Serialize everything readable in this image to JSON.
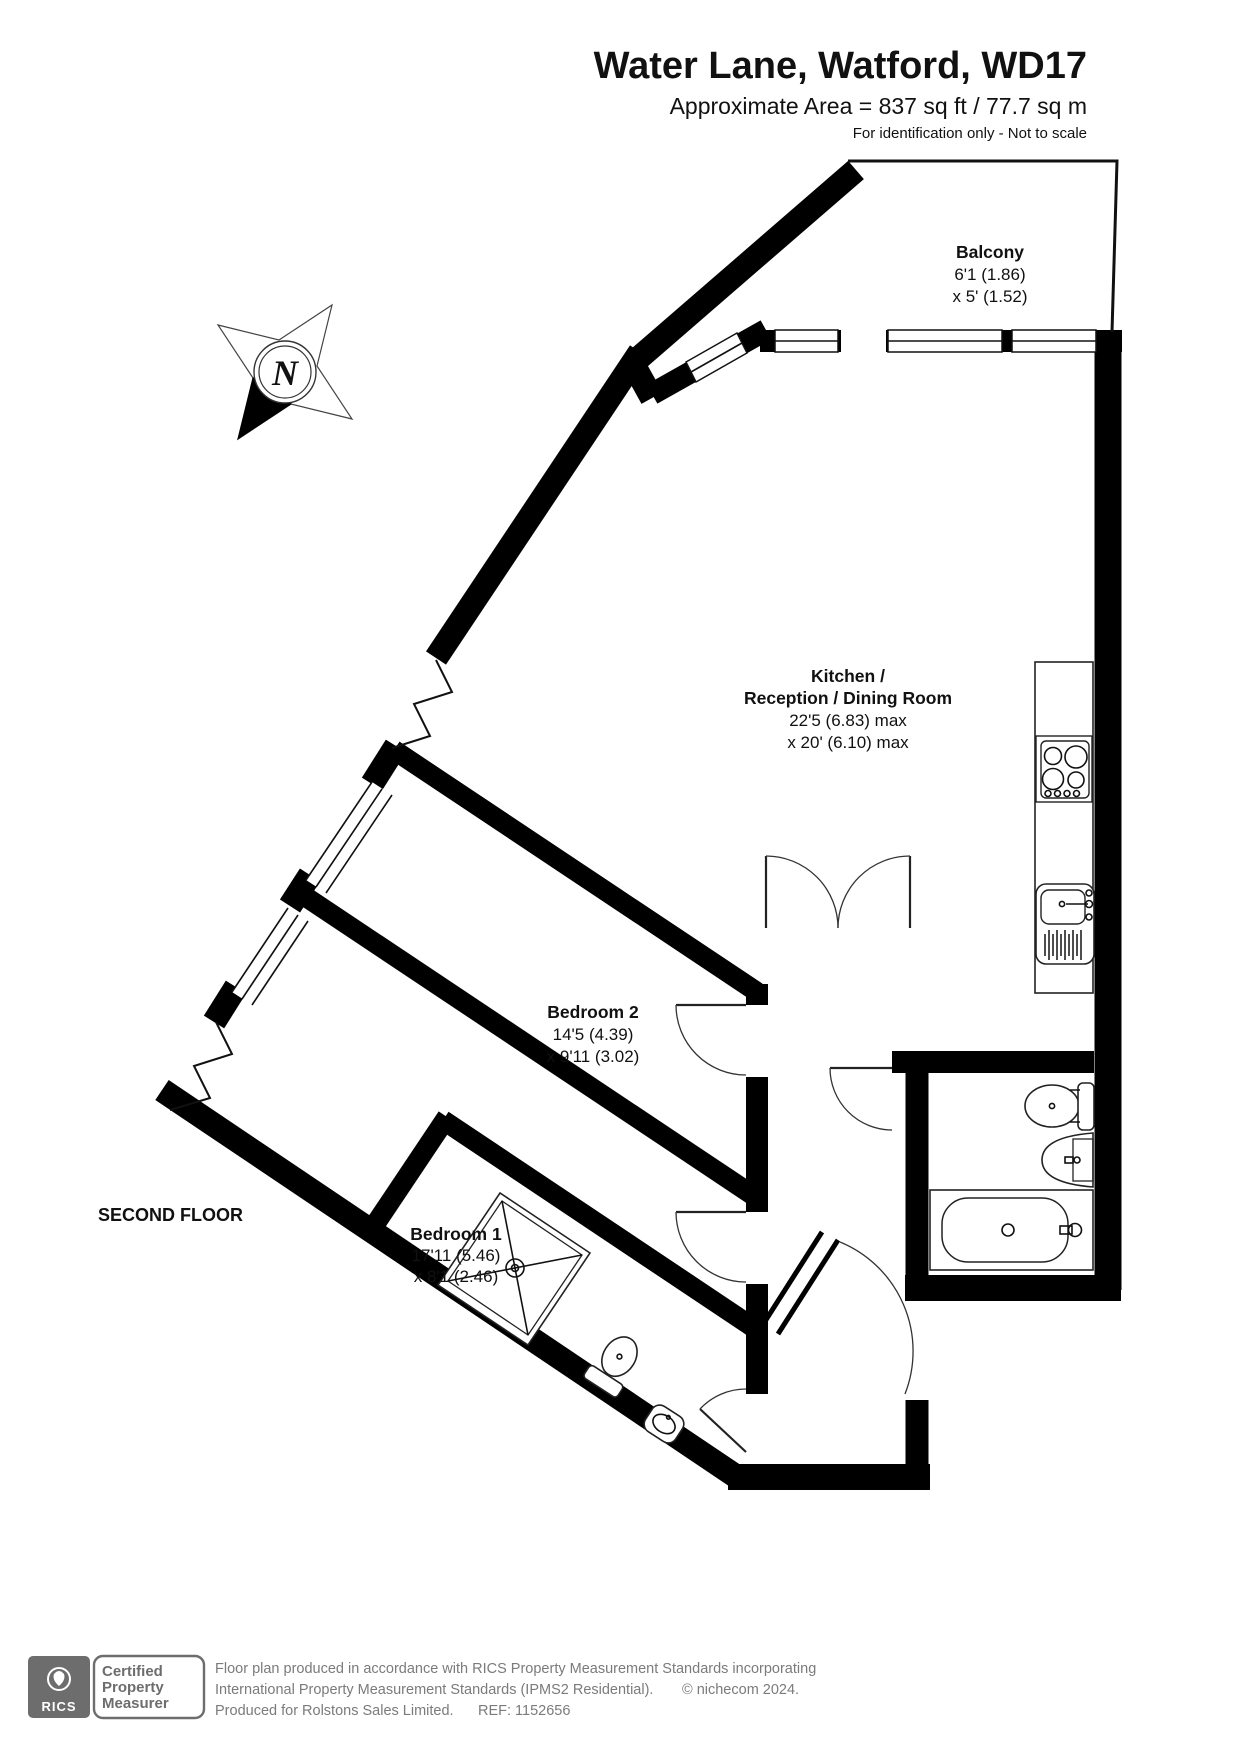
{
  "header": {
    "title": "Water Lane, Watford, WD17",
    "area": "Approximate Area = 837 sq ft / 77.7 sq m",
    "note": "For identification only - Not to scale"
  },
  "floor_label": "SECOND FLOOR",
  "compass": {
    "letter": "N"
  },
  "rooms": [
    {
      "name": "Balcony",
      "dim1": "6'1 (1.86)",
      "dim2": "x 5' (1.52)"
    },
    {
      "name": "Kitchen /",
      "name2": "Reception / Dining Room",
      "dim1": "22'5 (6.83) max",
      "dim2": "x 20' (6.10) max"
    },
    {
      "name": "Bedroom 2",
      "dim1": "14'5 (4.39)",
      "dim2": "x 9'11 (3.02)"
    },
    {
      "name": "Bedroom 1",
      "dim1": "17'11 (5.46)",
      "dim2": "x 8'1 (2.46)"
    }
  ],
  "footer": {
    "badge": {
      "org": "RICS",
      "lines": [
        "Certified",
        "Property",
        "Measurer"
      ]
    },
    "disclaimer_line1": "Floor plan produced in accordance with RICS Property Measurement Standards incorporating",
    "disclaimer_line2": "International Property Measurement Standards (IPMS2 Residential).",
    "copyright": "© nichecom 2024.",
    "produced_for": "Produced for Rolstons Sales Limited.",
    "ref": "REF:  1152656"
  },
  "colors": {
    "wall": "#000000",
    "footer_gray": "#6d6d6d"
  }
}
